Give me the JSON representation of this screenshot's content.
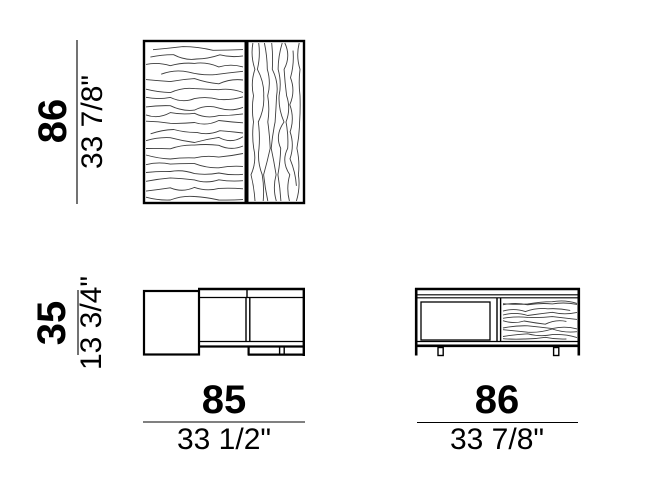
{
  "document": {
    "background_color": "#ffffff",
    "line_color": "#000000"
  },
  "views": {
    "top_left": {
      "vertical_dim": {
        "cm": "86",
        "inches": "33 7/8\""
      }
    },
    "bottom_left": {
      "vertical_dim": {
        "cm": "35",
        "inches": "13 3/4\""
      },
      "horizontal_dim": {
        "cm": "85",
        "inches": "33 1/2\""
      }
    },
    "bottom_right": {
      "horizontal_dim": {
        "cm": "86",
        "inches": "33 7/8\""
      }
    }
  }
}
